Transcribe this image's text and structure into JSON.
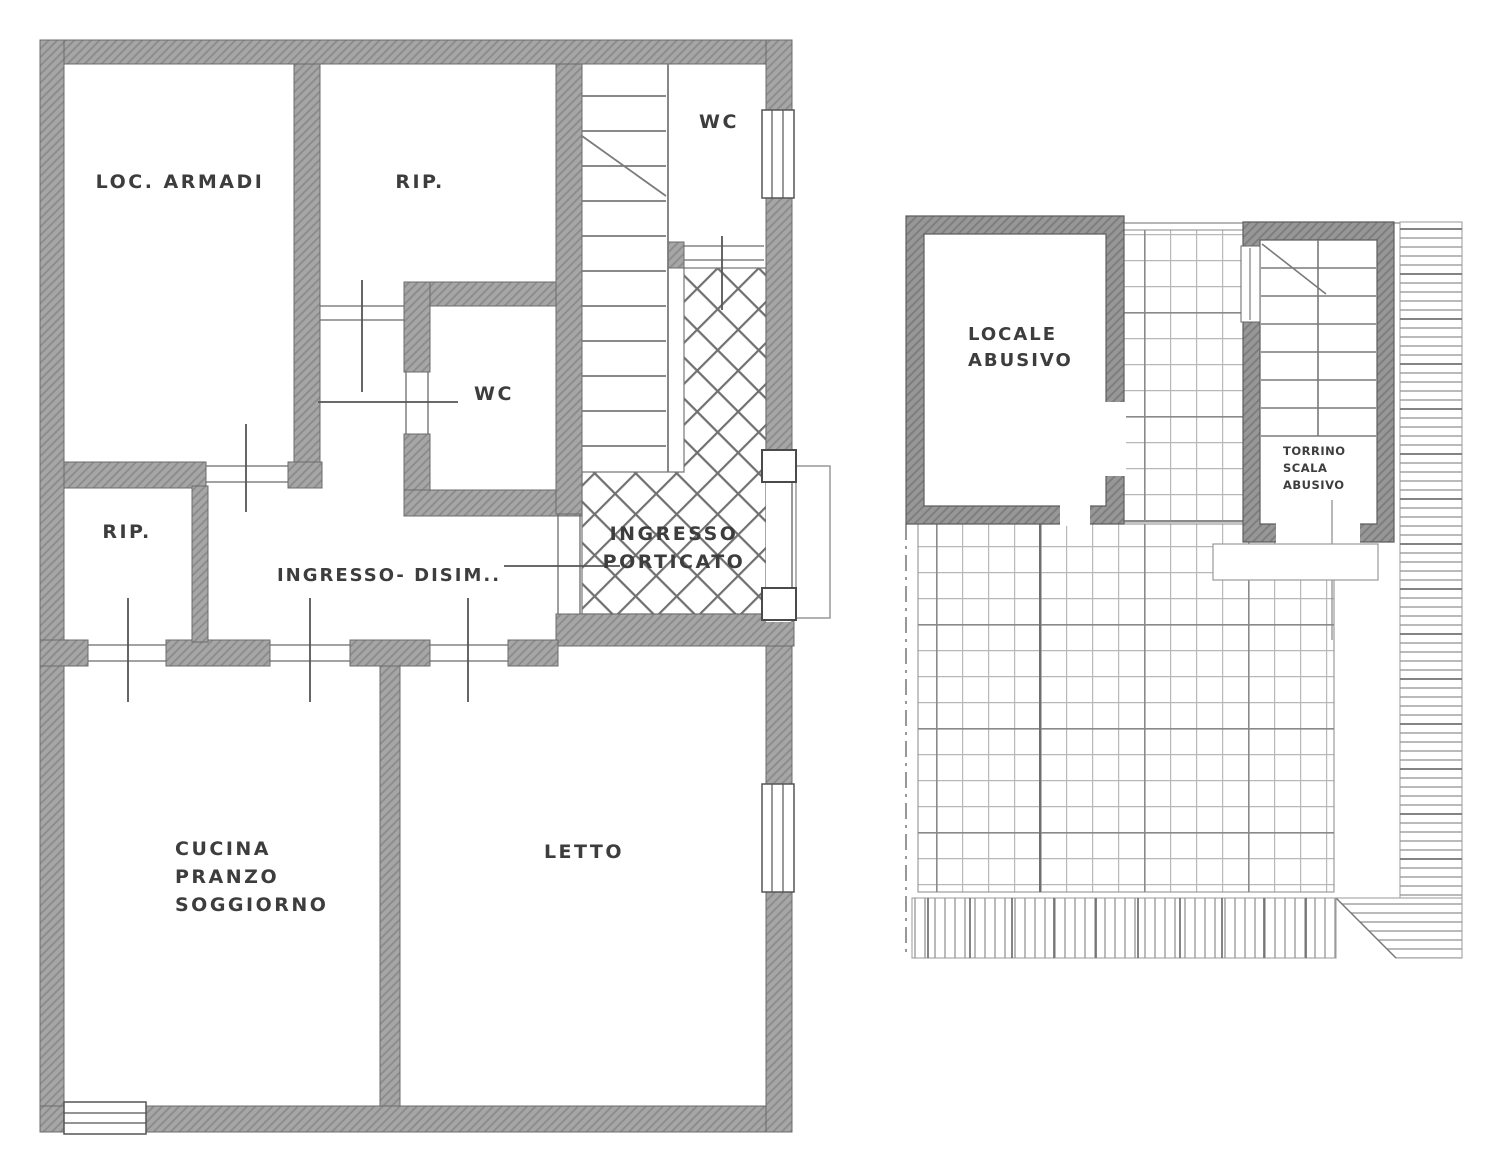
{
  "drawing": {
    "type": "architectural floor plan",
    "colors": {
      "wall": "#a6a6a6",
      "wall_hatch": "#8d8d8d",
      "wall_dark": "#969696",
      "outline": "#6b6b6b",
      "thin_line": "#9c9c9c",
      "text": "#3d3d3d",
      "background": "#ffffff"
    }
  },
  "left_plan": {
    "name": "main floor plan",
    "rooms": {
      "loc_armadi": "LOC. ARMADI",
      "rip_top": "RIP.",
      "wc_top": "WC",
      "wc_middle": "WC",
      "rip_side": "RIP.",
      "ingresso_disimpegno": "INGRESSO- DISIM..",
      "ingresso_porticato": [
        "INGRESSO",
        "PORTICATO"
      ],
      "cucina": [
        "CUCINA",
        "PRANZO",
        "SOGGIORNO"
      ],
      "letto": "LETTO"
    }
  },
  "right_plan": {
    "name": "roof terrace plan",
    "rooms": {
      "locale_abusivo": [
        "LOCALE",
        "ABUSIVO"
      ],
      "torrino": [
        "TORRINO",
        "SCALA",
        "ABUSIVO"
      ]
    }
  }
}
